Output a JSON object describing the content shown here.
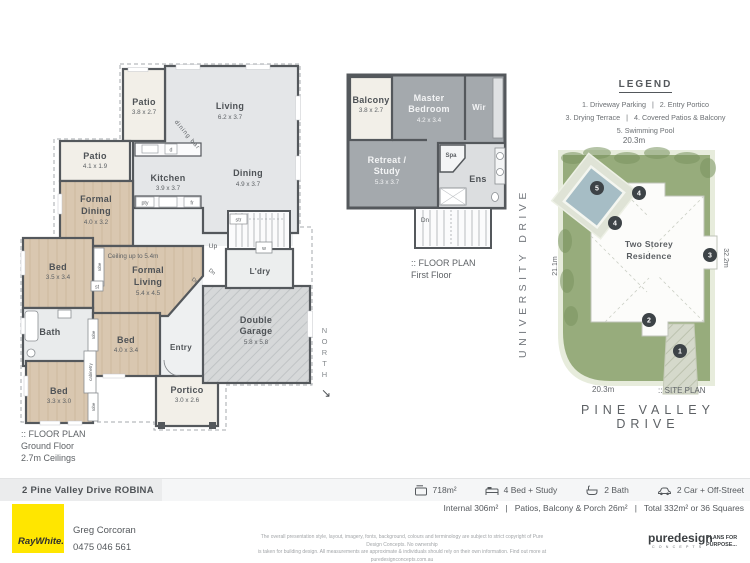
{
  "ground_floor": {
    "caption": {
      "marker": ":: FLOOR PLAN",
      "line1": "Ground Floor",
      "line2": "2.7m Ceilings"
    },
    "rooms": {
      "patio_top": {
        "name": "Patio",
        "dims": "3.8 x 2.7"
      },
      "living": {
        "name": "Living",
        "dims": "6.2 x 3.7"
      },
      "patio_left": {
        "name": "Patio",
        "dims": "4.1 x 1.9"
      },
      "kitchen": {
        "name": "Kitchen",
        "dims": "3.9 x 3.7"
      },
      "dining": {
        "name": "Dining",
        "dims": "4.9 x 3.7"
      },
      "formal_dining": {
        "name1": "Formal",
        "name2": "Dining",
        "dims": "4.0 x 3.2"
      },
      "formal_living": {
        "name1": "Formal",
        "name2": "Living",
        "dims": "5.4 x 4.5"
      },
      "bed1": {
        "name": "Bed",
        "dims": "3.5 x 3.4"
      },
      "bath": {
        "name": "Bath"
      },
      "bed2": {
        "name": "Bed",
        "dims": "4.0 x 3.4"
      },
      "bed3": {
        "name": "Bed",
        "dims": "3.3 x 3.0"
      },
      "entry": {
        "name": "Entry"
      },
      "portico": {
        "name": "Portico",
        "dims": "3.0 x 2.6"
      },
      "garage": {
        "name1": "Double",
        "name2": "Garage",
        "dims": "5.8 x 5.8"
      },
      "laundry": {
        "name": "L'dry"
      }
    },
    "annotations": {
      "ceiling": "Ceiling up to 5.4m",
      "dining_bar": "dining bar",
      "up": "Up",
      "dn": "Dn",
      "str": "str",
      "pty": "pty",
      "fr": "fr",
      "d": "d",
      "w": "w",
      "st": "st",
      "robe": "robe",
      "cabinetry": "cabinetry"
    }
  },
  "first_floor": {
    "caption": {
      "marker": ":: FLOOR PLAN",
      "line1": "First Floor"
    },
    "rooms": {
      "balcony": {
        "name": "Balcony",
        "dims": "3.8 x 2.7"
      },
      "master": {
        "name1": "Master",
        "name2": "Bedroom",
        "dims": "4.2 x 3.4"
      },
      "wir": {
        "name": "Wir"
      },
      "retreat": {
        "name1": "Retreat /",
        "name2": "Study",
        "dims": "5.3 x 3.7"
      },
      "spa": {
        "name": "Spa"
      },
      "ens": {
        "name": "Ens"
      }
    },
    "annotations": {
      "dn": "Dn"
    }
  },
  "compass": {
    "label": "NORTH",
    "arrow": "↘"
  },
  "site_plan": {
    "legend": {
      "title": "LEGEND",
      "line1": "1. Driveway Parking   |   2. Entry Portico",
      "line2": "3. Drying Terrace   |   4. Covered Patios & Balcony",
      "line3": "5. Swimming Pool"
    },
    "dims": {
      "top": "20.3m",
      "left": "21.1m",
      "right": "32.2m",
      "bottom": "20.3m"
    },
    "residence_label1": "Two Storey",
    "residence_label2": "Residence",
    "markers": {
      "m1": "1",
      "m2": "2",
      "m3": "3",
      "m4": "4",
      "m5": "5"
    },
    "caption": ":: SITE PLAN",
    "streets": {
      "side": "UNIVERSITY DRIVE",
      "front": "PINE VALLEY DRIVE"
    }
  },
  "footer": {
    "address": "2 Pine Valley Drive ROBINA",
    "stats": [
      {
        "icon": "land-area-icon",
        "label": "718m²"
      },
      {
        "icon": "bed-icon",
        "label": "4 Bed + Study"
      },
      {
        "icon": "bath-icon",
        "label": "2 Bath"
      },
      {
        "icon": "car-icon",
        "label": "2 Car + Off-Street"
      }
    ],
    "areas_line": "Internal 306m²   |   Patios, Balcony & Porch 26m²   |   Total 332m² or 36 Squares",
    "agent": {
      "name": "Greg Corcoran",
      "phone": "0475 046 561"
    },
    "brand": {
      "logo_text": "RayWhite."
    },
    "disclaimer_line1": "The overall presentation style, layout, imagery, fonts, background, colours and terminology are subject to strict copyright of Pure Design Concepts. No ownership",
    "disclaimer_line2": "is taken for building design. All measurements are approximate & individuals should rely on their own information. Find out more at puredesignconcepts.com.au",
    "designer": {
      "name": "puredesign",
      "sub": "C O N C E P T S",
      "tagline1": "PLANS FOR",
      "tagline2": "PURPOSE..."
    }
  }
}
